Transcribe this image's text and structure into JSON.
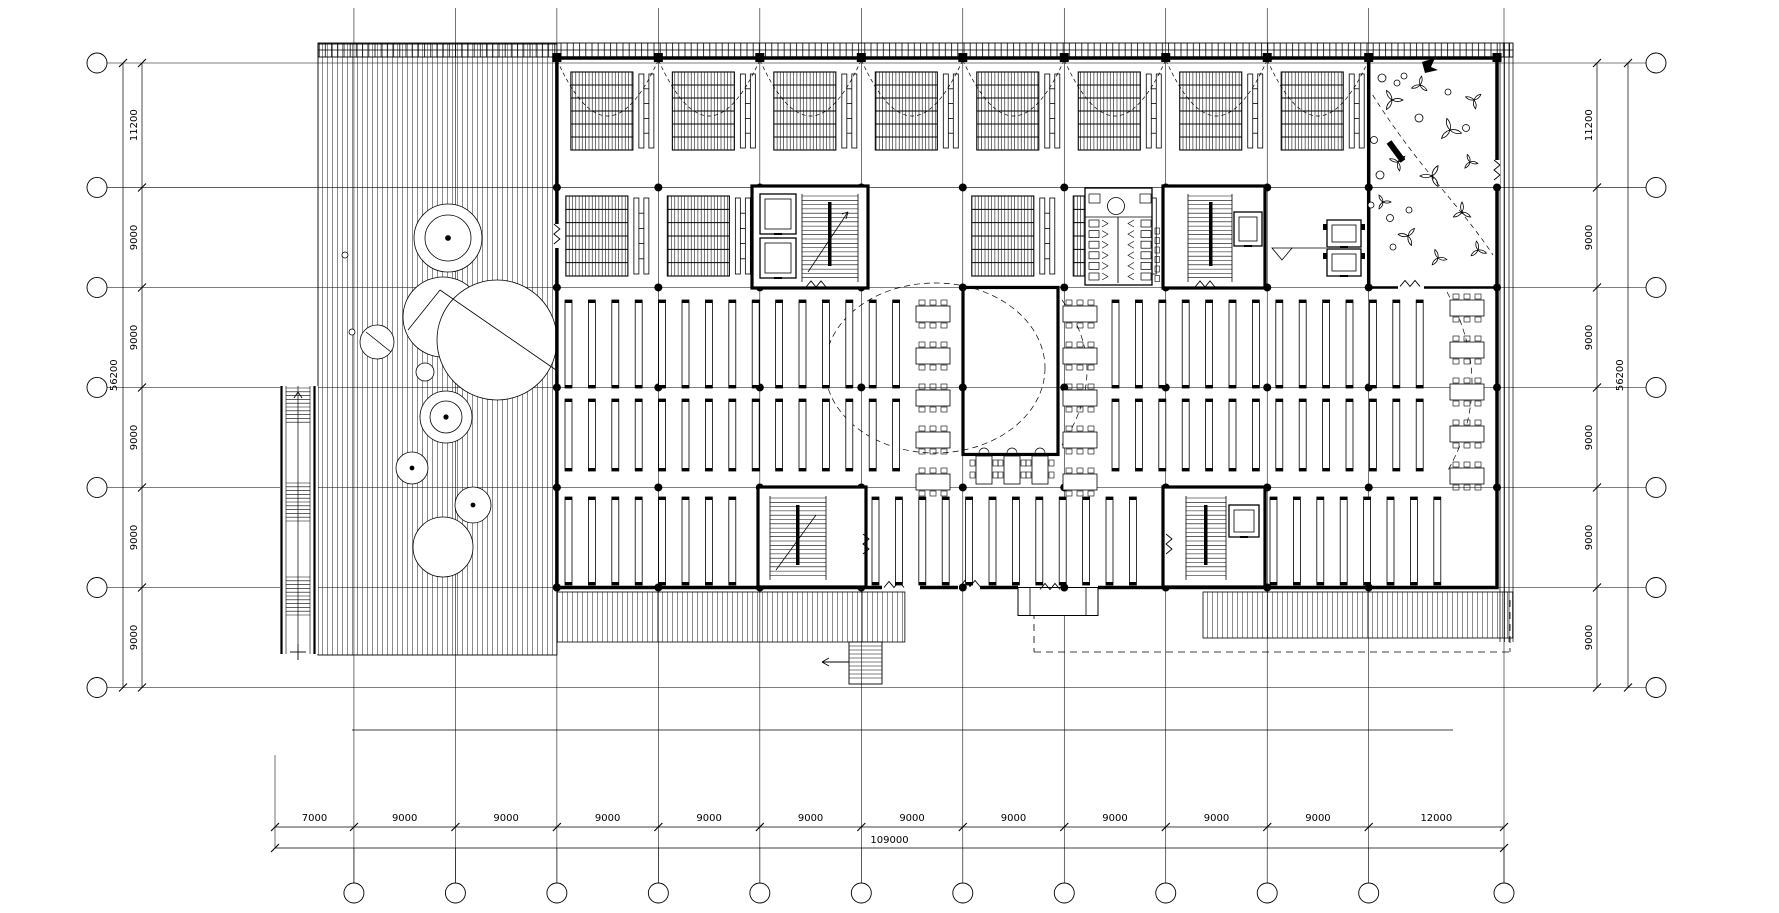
{
  "drawing": {
    "title": "Library building floor plan — CAD drawing",
    "type": "architectural-floor-plan",
    "background_color": "#ffffff",
    "line_color": "#000000"
  },
  "grid": {
    "vertical_axes": 13,
    "horizontal_axes": 7,
    "left_bubbles": 7,
    "right_bubbles": 7,
    "bottom_bubbles": 12,
    "bubble_labels": ""
  },
  "dimensions": {
    "left": {
      "spans": [
        "11200",
        "9000",
        "9000",
        "9000",
        "9000",
        "9000"
      ],
      "total": "56200"
    },
    "right": {
      "spans": [
        "11200",
        "9000",
        "9000",
        "9000",
        "9000",
        "9000"
      ],
      "total": "56200"
    },
    "bottom": {
      "spans": [
        "7000",
        "9000",
        "9000",
        "9000",
        "9000",
        "9000",
        "9000",
        "9000",
        "9000",
        "9000",
        "9000",
        "12000"
      ],
      "total": "109000"
    }
  }
}
